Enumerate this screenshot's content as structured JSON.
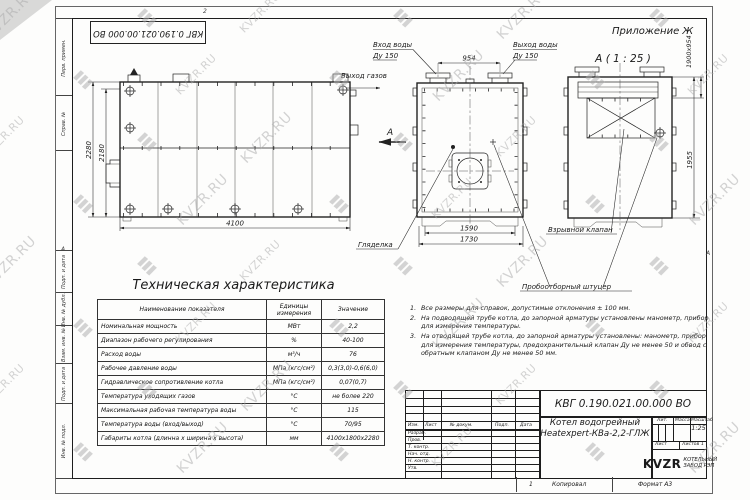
{
  "frame": {
    "stamp_top": "КВГ 0.190.021.00.000 ВО",
    "zone_top": "2",
    "zone_left": "А",
    "zone_right": "А",
    "side_labels": [
      "Перв. примен.",
      "Справ. №",
      "Подп. и дата",
      "Инв. № дубл.",
      "Взам. инв. №",
      "Подп. и дата",
      "Инв. № подл."
    ],
    "footer": {
      "page": "1",
      "copied": "Копировал",
      "format": "Формат А3"
    }
  },
  "drawing": {
    "appendix": "Приложение Ж",
    "view_label": "А ( 1 : 25 )",
    "labels": {
      "water_in": "Вход воды",
      "water_in_du": "Ду 150",
      "water_out": "Выход воды",
      "water_out_du": "Ду 150",
      "gas_out": "Выход газов",
      "section": "А",
      "peephole": "Гляделка",
      "explosion_valve": "Взрывной клапан",
      "sampling": "Пробоотборный штуцер"
    },
    "dims": {
      "d954": "954",
      "d2280": "2280",
      "d2180": "2180",
      "d4100": "4100",
      "d1590": "1590",
      "d1730": "1730",
      "d1955": "1955",
      "d1900": "1900х954"
    }
  },
  "table": {
    "title": "Техническая характеристика",
    "headers": [
      "Наименование показателя",
      "Единицы измерения",
      "Значение"
    ],
    "rows": [
      [
        "Номинальная мощность",
        "МВт",
        "2,2"
      ],
      [
        "Диапазон рабочего регулирования",
        "%",
        "40-100"
      ],
      [
        "Расход воды",
        "м³/ч",
        "76"
      ],
      [
        "Рабочее давление воды",
        "МПа (кгс/см²)",
        "0,3(3,0)-0,6(6,0)"
      ],
      [
        "Гидравлическое сопротивление котла",
        "МПа (кгс/см²)",
        "0,07(0,7)"
      ],
      [
        "Температура уходящих газов",
        "°С",
        "не более 220"
      ],
      [
        "Максимальная рабочая температура воды",
        "°С",
        "115"
      ],
      [
        "Температура воды (вход/выход)",
        "°С",
        "70/95"
      ],
      [
        "Габариты котла (длинна х ширина х высота)",
        "мм",
        "4100х1800х2280"
      ]
    ]
  },
  "notes": {
    "items": [
      "Все размеры для справок, допустимые отклонения ± 100 мм.",
      "На подводящей трубе котла, до запорной арматуры установлены манометр, прибор для измерения температуры.",
      "На отводящей трубе котла, до запорной арматуры установлены: манометр, прибор для измерения температуры, предохранительный клапан Ду не менее 50 и обвод с обратным клапаном Ду не менее 50 мм."
    ]
  },
  "titleblock": {
    "doc_number": "КВГ 0.190.021.00.000 ВО",
    "header_cols": [
      "Изм.",
      "Лист",
      "№ докум.",
      "Подп.",
      "Дата"
    ],
    "sig_rows": [
      "Разраб.",
      "Пров.",
      "Т. контр.",
      "Нач. отд.",
      "Н. контр.",
      "Утв."
    ],
    "product_line1": "Котел водогрейный",
    "product_line2": "Heatexpert-КВа-2,2-ГЛЖ",
    "lit_label": "Лит.",
    "mass_label": "Масса",
    "scale_label": "Масштаб",
    "scale_value": "1:25",
    "sheet_label": "Лист",
    "sheets_label": "Листов",
    "sheets_value": "1",
    "brand": "KVZR",
    "company_line1": "КОТЕЛЬНЫЙ",
    "company_line2": "ЗАВОД РЭП"
  },
  "watermark": {
    "text": "KVZR.RU"
  }
}
